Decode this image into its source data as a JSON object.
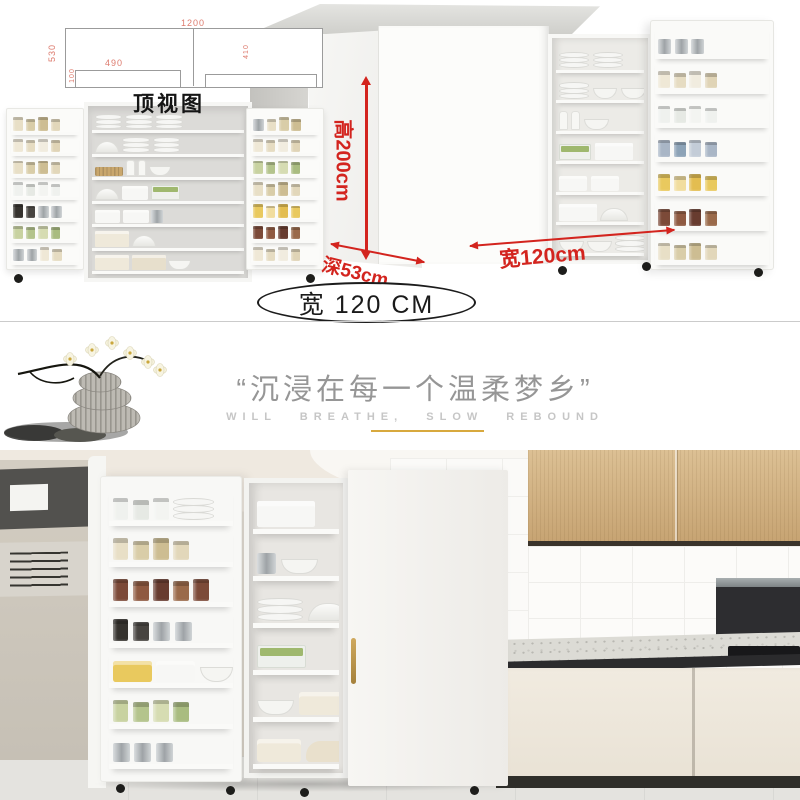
{
  "top_drawing": {
    "label": "顶视图",
    "dims": {
      "total_width": "1200",
      "left_height": "530",
      "inner_width": "490",
      "small_left": "100",
      "small_right": "410"
    }
  },
  "dimension_labels": {
    "height": "高200cm",
    "depth": "深53cm",
    "width": "宽120cm"
  },
  "badge": {
    "text": "宽 120 CM"
  },
  "slogan": {
    "chinese": "“沉浸在每一个温柔梦乡”",
    "english": "WILL BREATHE, SLOW REBOUND"
  },
  "colors": {
    "annotation_red": "#d3241e",
    "drawing_dim_red": "#dd7b6e",
    "gold_underline": "#d8a93e",
    "slogan_gray": "#969696",
    "english_gray": "#c6c6c6",
    "wood_cabinet": "#cfae7c"
  },
  "palettes": {
    "grain": [
      "#e8dfc6",
      "#d9cda8",
      "#cdbd92",
      "#e2d7ba"
    ],
    "cream": [
      "#efe8d6",
      "#e6dcc2",
      "#f1ecdf",
      "#e0d4b6"
    ],
    "jam": [
      "#7c4a38",
      "#8f5a41",
      "#683c2f",
      "#9a6a4a"
    ],
    "greens": [
      "#c8d2a0",
      "#b4c48c",
      "#d6dcb2",
      "#a9bc80"
    ],
    "steel": [
      "#cfd3d5",
      "#b9bec1",
      "#dadedf"
    ],
    "yellow": [
      "#e9c95e",
      "#f1dd9e",
      "#e3bd50"
    ],
    "caps": [
      "#35322e",
      "#474440",
      "#2b2926"
    ],
    "clear": [
      "#eff1ee",
      "#e6e9e4",
      "#f3f4f1"
    ],
    "blue": [
      "#a9b6c6",
      "#8da3b7",
      "#c3ccd7"
    ],
    "white": [
      "#f7f7f5"
    ],
    "creamL": [
      "#efe9da",
      "#e7dfcc"
    ]
  }
}
